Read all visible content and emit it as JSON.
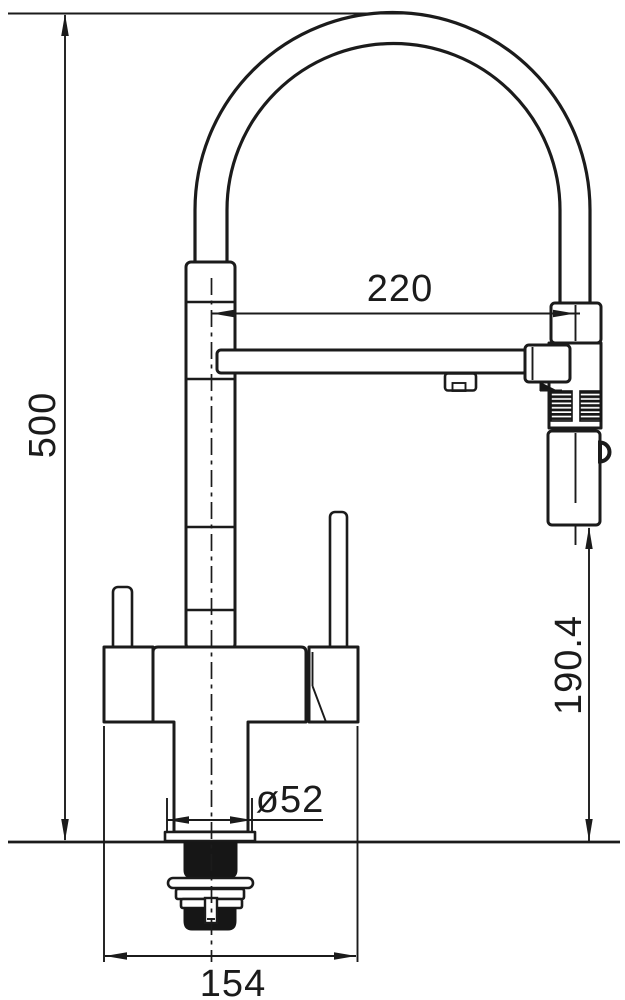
{
  "page": {
    "background_color": "#ffffff",
    "line_color": "#1b1b1b"
  },
  "drawing": {
    "kind": "technical-dimension-drawing",
    "subject": "kitchen faucet with high-arc spout, pull-down sprayer and under-counter mounting hardware, side elevation",
    "units": "mm",
    "dimensions": {
      "overall_height": "500",
      "spout_reach": "220",
      "sprayer_outlet_height": "190.4",
      "mounting_hole_diameter": "ø52",
      "base_footprint_width": "154"
    }
  }
}
